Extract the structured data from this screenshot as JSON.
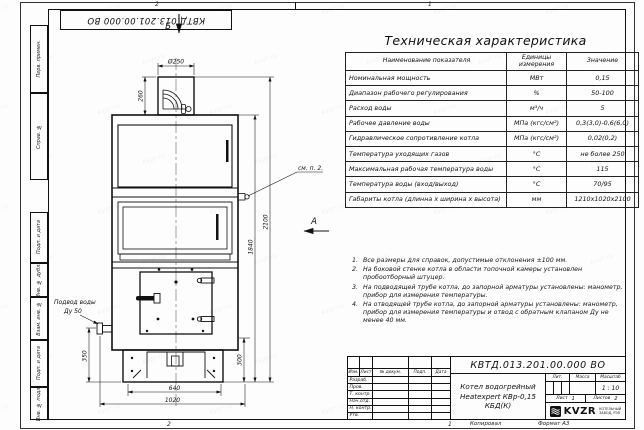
{
  "doc_number": "КВТД.013.201.00.000 ВО",
  "sheet": {
    "zone_top_left": "2",
    "zone_top_right": "1",
    "zone_bottom_left": "2",
    "zone_bottom_right": "1",
    "footer_copy": "Копировал",
    "footer_format": "Формат А3",
    "side_labels": [
      "Перв. примен.",
      "Справ. №",
      "Подп. и дата",
      "Инв. № дубл.",
      "Взам. инв. №",
      "Подп. и дата",
      "Инв. № подл."
    ]
  },
  "drawing": {
    "views": {
      "a": "А",
      "b": "Б"
    },
    "dims": {
      "chimney_dia": "Ø250",
      "chimney_h": "260",
      "inlet_h": "350",
      "base_h": "300",
      "body_h": "1840",
      "overall_h": "2100",
      "opening_w": "640",
      "overall_w": "1020"
    },
    "labels": {
      "inlet_line1": "Подвод воды",
      "inlet_line2": "Ду 50",
      "see_note": "см. п. 2."
    }
  },
  "spec_table": {
    "title": "Техническая характеристика",
    "headers": [
      "Наименование показателя",
      "Единицы измерения",
      "Значение"
    ],
    "rows": [
      [
        "Номинальная мощность",
        "МВт",
        "0,15"
      ],
      [
        "Диапазон рабочего регулирования",
        "%",
        "50-100"
      ],
      [
        "Расход воды",
        "м³/ч",
        "5"
      ],
      [
        "Рабочее давление воды",
        "МПа (кгс/см²)",
        "0,3(3,0)-0,6(6,0)"
      ],
      [
        "Гидравлическое сопротивление котла",
        "МПа (кгс/см²)",
        "0,02(0,2)"
      ],
      [
        "Температура уходящих газов",
        "°С",
        "не более 250"
      ],
      [
        "Максимальная рабочая температура воды",
        "°С",
        "115"
      ],
      [
        "Температура воды (вход/выход)",
        "°С",
        "70/95"
      ],
      [
        "Габариты котла (длинна х ширина х высота)",
        "мм",
        "1210х1020х2100"
      ]
    ]
  },
  "notes": [
    {
      "num": "1.",
      "text": "Все размеры для справок, допустимые отклонения ±100 мм."
    },
    {
      "num": "2.",
      "text": "На боковой стенке котла в области топочной камеры установлен пробоотборный штуцер."
    },
    {
      "num": "3.",
      "text": "На подводящей трубе котла, до запорной арматуры установлены: манометр, прибор для измерения температуры."
    },
    {
      "num": "4.",
      "text": "На отводящей трубе котла, до запорной арматуры установлены: манометр, прибор для измерения температуры и отвод с обратным клапаном Ду не менее 40 мм."
    }
  ],
  "title_block": {
    "change_header": [
      "Изм.",
      "Лист",
      "№ докум.",
      "Подп.",
      "Дата"
    ],
    "signature_rows": [
      "Разраб.",
      "Пров.",
      "Т. контр.",
      "Нач.отд.",
      "Н. контр.",
      "Утв."
    ],
    "product_name_1": "Котел водогрейный",
    "product_name_2": "Heatexpert КВр-0,15 КБД(К)",
    "lit_label": "Лит.",
    "mass_label": "Масса",
    "scale_label": "Масштаб",
    "scale_value": "1 : 10",
    "sheet_label": "Лист",
    "sheet_value": "1",
    "sheets_label": "Листов",
    "sheets_value": "2",
    "logo_text": "KVZR",
    "logo_sub1": "КОТЕЛЬНЫЙ",
    "logo_sub2": "ЗАВОД, РЭП"
  },
  "watermark": {
    "text": "kvzr.ru"
  }
}
